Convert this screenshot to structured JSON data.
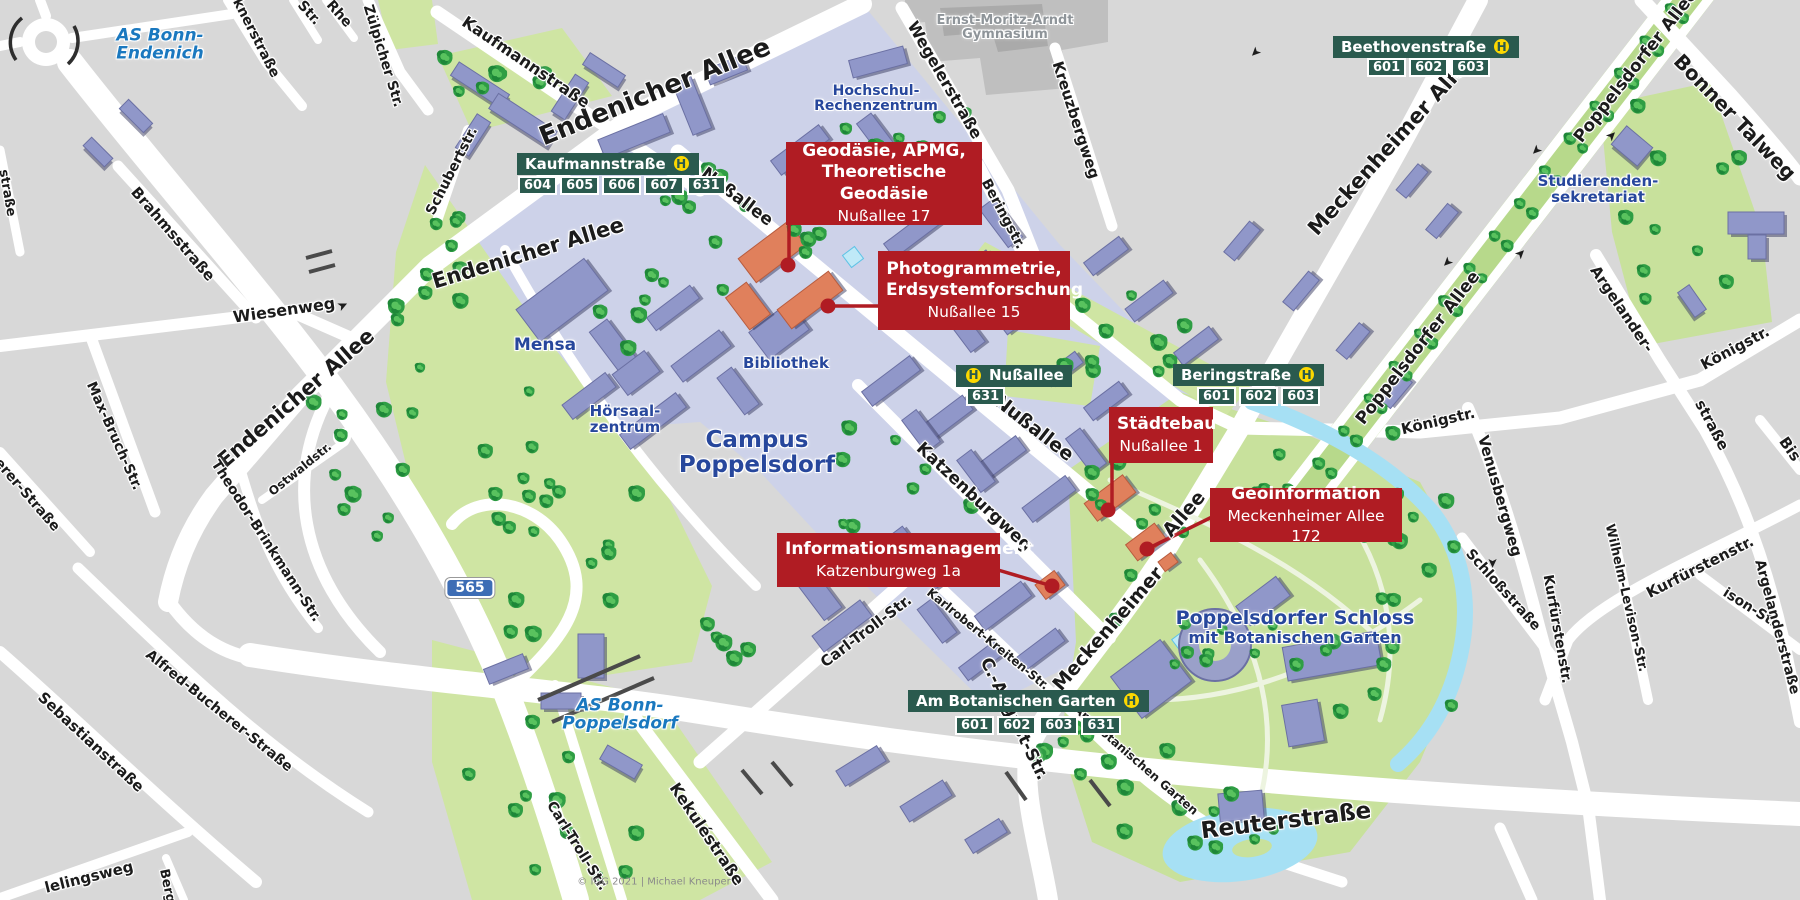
{
  "map": {
    "copyright": "© IGG 2021 | Michael Kneuper",
    "motorway_badge": "565",
    "h_symbol": "H"
  },
  "callouts": [
    {
      "title_lines": [
        "Geodäsie, APMG,",
        "Theoretische Geodäsie"
      ],
      "address": "Nußallee 17",
      "box": {
        "x": 786,
        "y": 142,
        "w": 196,
        "h": 83
      },
      "dot": {
        "x": 788,
        "y": 265
      },
      "leader": [
        [
          789,
          225
        ],
        [
          789,
          265
        ]
      ]
    },
    {
      "title_lines": [
        "Photogrammetrie,",
        "Erdsystemforschung"
      ],
      "address": "Nußallee 15",
      "box": {
        "x": 878,
        "y": 251,
        "w": 192,
        "h": 79
      },
      "dot": {
        "x": 828,
        "y": 306
      },
      "leader": [
        [
          878,
          306
        ],
        [
          828,
          306
        ]
      ]
    },
    {
      "title_lines": [
        "Städtebau"
      ],
      "address": "Nußallee 1",
      "box": {
        "x": 1109,
        "y": 407,
        "w": 104,
        "h": 56
      },
      "dot": {
        "x": 1108,
        "y": 510
      },
      "leader": [
        [
          1112,
          463
        ],
        [
          1112,
          510
        ]
      ]
    },
    {
      "title_lines": [
        "Geoinformation"
      ],
      "address": "Meckenheimer Allee 172",
      "box": {
        "x": 1210,
        "y": 488,
        "w": 192,
        "h": 54
      },
      "dot": {
        "x": 1147,
        "y": 549
      },
      "leader": [
        [
          1212,
          517
        ],
        [
          1147,
          549
        ]
      ]
    },
    {
      "title_lines": [
        "Informationsmanagement"
      ],
      "address": "Katzenburgweg 1a",
      "box": {
        "x": 777,
        "y": 533,
        "w": 223,
        "h": 54
      },
      "dot": {
        "x": 1052,
        "y": 586
      },
      "leader": [
        [
          998,
          570
        ],
        [
          1052,
          586
        ]
      ]
    }
  ],
  "bus_stops": [
    {
      "name": "Kaufmannstraße",
      "lines": [
        "604",
        "605",
        "606",
        "607",
        "631"
      ],
      "x": 517,
      "y": 153,
      "h_side": "right",
      "chips_x": 518,
      "chips_y": 176
    },
    {
      "name": "Beethovenstraße",
      "lines": [
        "601",
        "602",
        "603"
      ],
      "x": 1333,
      "y": 36,
      "h_side": "right",
      "chips_x": 1367,
      "chips_y": 58
    },
    {
      "name": "Nußallee",
      "lines": [
        "631"
      ],
      "x": 956,
      "y": 364,
      "h_side": "left",
      "chips_x": 966,
      "chips_y": 387
    },
    {
      "name": "Beringstraße",
      "lines": [
        "601",
        "602",
        "603"
      ],
      "x": 1173,
      "y": 364,
      "h_side": "right",
      "chips_x": 1197,
      "chips_y": 387
    },
    {
      "name": "Am Botanischen Garten",
      "lines": [
        "601",
        "602",
        "603",
        "631"
      ],
      "x": 908,
      "y": 690,
      "h_side": "right",
      "chips_x": 955,
      "chips_y": 716
    }
  ],
  "street_labels": [
    {
      "t": "Endenicher Allee",
      "x": 655,
      "y": 92,
      "r": -22,
      "s": 26
    },
    {
      "t": "Endenicher Allee",
      "x": 528,
      "y": 253,
      "r": -17,
      "s": 21
    },
    {
      "t": "Endenicher Allee",
      "x": 296,
      "y": 398,
      "r": -41,
      "s": 21
    },
    {
      "t": "Wiesenweg",
      "x": 284,
      "y": 310,
      "r": -8,
      "s": 16
    },
    {
      "t": "Nußallee",
      "x": 737,
      "y": 197,
      "r": 37,
      "s": 17
    },
    {
      "t": "Nußallee",
      "x": 1034,
      "y": 428,
      "r": 38,
      "s": 19
    },
    {
      "t": "Wegelerstraße",
      "x": 945,
      "y": 80,
      "r": 60,
      "s": 16
    },
    {
      "t": "Kreuzbergweg",
      "x": 1076,
      "y": 120,
      "r": 72,
      "s": 15
    },
    {
      "t": "Beringstr.",
      "x": 1003,
      "y": 214,
      "r": 62,
      "s": 14
    },
    {
      "t": "Meckenheimer Allee",
      "x": 1392,
      "y": 143,
      "r": -48,
      "s": 21
    },
    {
      "t": "Meckenheimer",
      "x": 1108,
      "y": 629,
      "r": -49,
      "s": 19
    },
    {
      "t": "Allee",
      "x": 1184,
      "y": 514,
      "r": -49,
      "s": 19
    },
    {
      "t": "Poppelsdorfer Allee",
      "x": 1418,
      "y": 348,
      "r": -52,
      "s": 17
    },
    {
      "t": "Poppelsdorfer Allee",
      "x": 1636,
      "y": 66,
      "r": -52,
      "s": 17
    },
    {
      "t": "Bonner Talweg",
      "x": 1735,
      "y": 117,
      "r": 46,
      "s": 20
    },
    {
      "t": "Argelander-",
      "x": 1622,
      "y": 309,
      "r": 56,
      "s": 15
    },
    {
      "t": "straße",
      "x": 1712,
      "y": 425,
      "r": 62,
      "s": 15
    },
    {
      "t": "Königstr.",
      "x": 1438,
      "y": 421,
      "r": -13,
      "s": 15
    },
    {
      "t": "Königstr.",
      "x": 1735,
      "y": 348,
      "r": -28,
      "s": 15
    },
    {
      "t": "Bis",
      "x": 1790,
      "y": 449,
      "r": 55,
      "s": 15
    },
    {
      "t": "Venusbergweg",
      "x": 1500,
      "y": 496,
      "r": 74,
      "s": 15
    },
    {
      "t": "Kurfürstenstr.",
      "x": 1700,
      "y": 567,
      "r": -27,
      "s": 15
    },
    {
      "t": "Kurfürstenstr.",
      "x": 1557,
      "y": 629,
      "r": 80,
      "s": 14
    },
    {
      "t": "Wilhelm-Levison-Str.",
      "x": 1626,
      "y": 598,
      "r": 77,
      "s": 13
    },
    {
      "t": "ison-Str.",
      "x": 1752,
      "y": 609,
      "r": 32,
      "s": 14
    },
    {
      "t": "Schloßstraße",
      "x": 1503,
      "y": 590,
      "r": 48,
      "s": 14
    },
    {
      "t": "Argelanderstraße",
      "x": 1777,
      "y": 627,
      "r": 75,
      "s": 14
    },
    {
      "t": "Reuterstraße",
      "x": 1286,
      "y": 821,
      "r": -7,
      "s": 23
    },
    {
      "t": "Kekuléstraße",
      "x": 707,
      "y": 834,
      "r": 56,
      "s": 16
    },
    {
      "t": "Carl-Troll-Str.",
      "x": 866,
      "y": 631,
      "r": -37,
      "s": 15
    },
    {
      "t": "Carl-Troll-Str.",
      "x": 577,
      "y": 846,
      "r": 58,
      "s": 14
    },
    {
      "t": "Karlrobert-Kreiten-Str.",
      "x": 988,
      "y": 639,
      "r": 39,
      "s": 12
    },
    {
      "t": "Katzenburgweg",
      "x": 974,
      "y": 497,
      "r": 43,
      "s": 17
    },
    {
      "t": "C.-August-Str.",
      "x": 1014,
      "y": 719,
      "r": 64,
      "s": 17
    },
    {
      "t": "Am Botanischen Garten",
      "x": 1136,
      "y": 760,
      "r": 41,
      "s": 12
    },
    {
      "t": "Kaufmannstraße",
      "x": 526,
      "y": 62,
      "r": 34,
      "s": 16
    },
    {
      "t": "Zülpicher Str.",
      "x": 383,
      "y": 56,
      "r": 73,
      "s": 14
    },
    {
      "t": "Schubertstr.",
      "x": 452,
      "y": 171,
      "r": -63,
      "s": 14
    },
    {
      "t": "knerstraße",
      "x": 256,
      "y": 38,
      "r": 63,
      "s": 14
    },
    {
      "t": "Str.",
      "x": 309,
      "y": 13,
      "r": 48,
      "s": 14
    },
    {
      "t": "Rhe",
      "x": 339,
      "y": 14,
      "r": 48,
      "s": 14
    },
    {
      "t": "Brahmsstraße",
      "x": 173,
      "y": 234,
      "r": 49,
      "s": 15
    },
    {
      "t": "Max-Bruch-Str.",
      "x": 114,
      "y": 436,
      "r": 66,
      "s": 14
    },
    {
      "t": "Theodor-Brinkmann-Str.",
      "x": 266,
      "y": 541,
      "r": 57,
      "s": 14
    },
    {
      "t": "Ostwaldstr.",
      "x": 300,
      "y": 469,
      "r": -39,
      "s": 12
    },
    {
      "t": "erer-Straße",
      "x": 27,
      "y": 495,
      "r": 49,
      "s": 14
    },
    {
      "t": "Sebastianstraße",
      "x": 91,
      "y": 742,
      "r": 43,
      "s": 15
    },
    {
      "t": "Alfred-Bucherer-Straße",
      "x": 219,
      "y": 711,
      "r": 39,
      "s": 14
    },
    {
      "t": "lelingsweg",
      "x": 89,
      "y": 877,
      "r": -14,
      "s": 15
    },
    {
      "t": "Berg",
      "x": 167,
      "y": 886,
      "r": 78,
      "s": 13
    },
    {
      "t": "straße",
      "x": 7,
      "y": 193,
      "r": 80,
      "s": 13
    }
  ],
  "area_labels": [
    {
      "lines": [
        "AS Bonn-",
        "Endenich"
      ],
      "x": 160,
      "y": 45,
      "s": 17,
      "cls": "as"
    },
    {
      "lines": [
        "AS Bonn-",
        "Poppelsdorf"
      ],
      "x": 620,
      "y": 715,
      "s": 17,
      "cls": "as"
    },
    {
      "lines": [
        "Campus",
        "Poppelsdorf"
      ],
      "x": 757,
      "y": 453,
      "s": 23,
      "cls": "campus"
    },
    {
      "lines": [
        "Mensa"
      ],
      "x": 545,
      "y": 345,
      "s": 17,
      "cls": "campus"
    },
    {
      "lines": [
        "Bibliothek"
      ],
      "x": 786,
      "y": 363,
      "s": 15,
      "cls": "campus"
    },
    {
      "lines": [
        "Hörsaal-",
        "zentrum"
      ],
      "x": 625,
      "y": 419,
      "s": 15,
      "cls": "campus"
    },
    {
      "lines": [
        "Hochschul-",
        "Rechenzentrum"
      ],
      "x": 876,
      "y": 99,
      "s": 14,
      "cls": "campus"
    },
    {
      "lines": [
        "Poppelsdorfer Schloss",
        "mit Botanischen Garten"
      ],
      "x": 1295,
      "y": 627,
      "s": 19,
      "cls": "campus",
      "sub": true
    },
    {
      "lines": [
        "Studierenden-",
        "sekretariat"
      ],
      "x": 1598,
      "y": 189,
      "s": 15,
      "cls": "campus"
    },
    {
      "lines": [
        "Ernst-Moritz-Arndt",
        "Gymnasium"
      ],
      "x": 1005,
      "y": 28,
      "s": 13,
      "cls": "gray"
    }
  ],
  "arrows": [
    {
      "x": 1255,
      "y": 52,
      "r": 135
    },
    {
      "x": 1447,
      "y": 262,
      "r": 135
    },
    {
      "x": 1521,
      "y": 254,
      "r": -45
    },
    {
      "x": 1612,
      "y": 136,
      "r": -45
    },
    {
      "x": 1536,
      "y": 150,
      "r": 135
    },
    {
      "x": 1492,
      "y": 563,
      "r": 90
    },
    {
      "x": 343,
      "y": 306,
      "r": -25
    }
  ]
}
